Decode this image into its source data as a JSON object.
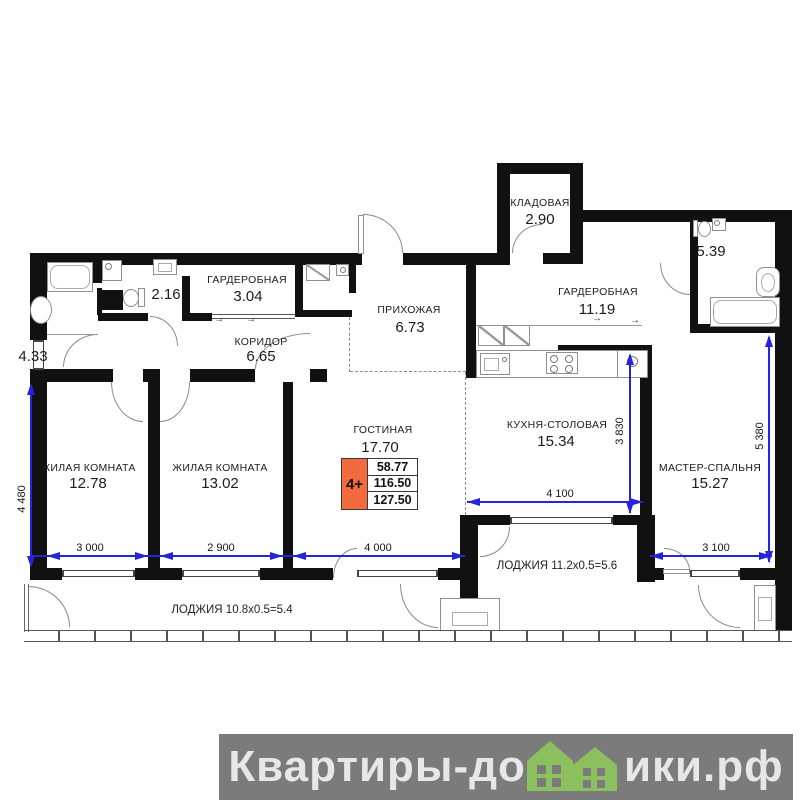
{
  "plan": {
    "rooms": {
      "storage": {
        "name": "КЛАДОВАЯ",
        "area": "2.90"
      },
      "wardrobe_small": {
        "name": "ГАРДЕРОБНАЯ",
        "area": "3.04"
      },
      "wardrobe_large": {
        "name": "ГАРДЕРОБНАЯ",
        "area": "11.19"
      },
      "hallway": {
        "name": "ПРИХОЖАЯ",
        "area": "6.73"
      },
      "corridor": {
        "name": "КОРИДОР",
        "area": "6.65"
      },
      "kitchen": {
        "name": "КУХНЯ-СТОЛОВАЯ",
        "area": "15.34"
      },
      "master": {
        "name": "МАСТЕР-СПАЛЬНЯ",
        "area": "15.27"
      },
      "living1": {
        "name": "ЖИЛАЯ КОМНАТА",
        "area": "12.78"
      },
      "living2": {
        "name": "ЖИЛАЯ КОМНАТА",
        "area": "13.02"
      },
      "livingroom": {
        "name": "ГОСТИНАЯ",
        "area": "17.70"
      },
      "bath_left": {
        "area": "4.33"
      },
      "wc": {
        "area": "2.16"
      },
      "bath_right": {
        "area": "5.39"
      }
    },
    "loggias": {
      "left": "ЛОДЖИЯ 10.8x0.5=5.4",
      "right": "ЛОДЖИЯ 11.2x0.5=5.6"
    },
    "dimensions": {
      "bottom": [
        "3 000",
        "2 900",
        "4 000"
      ],
      "left_v": "4 480",
      "kitchen_w": "4 100",
      "kitchen_v": "3 830",
      "master_w": "3 100",
      "master_v": "5 380"
    },
    "badge": {
      "rooms": "4+",
      "living_area": "58.77",
      "area": "116.50",
      "total_area": "127.50"
    },
    "sliding_arrow": "→",
    "colors": {
      "wall": "#111111",
      "dimension_blue": "#2424d8",
      "badge_orange": "#f26a3d"
    }
  },
  "watermark": {
    "text_before": "Квартиры-до",
    "text_after": "ики.рф",
    "bg": "#7b7b7b",
    "house_green": "#8cc05f"
  }
}
